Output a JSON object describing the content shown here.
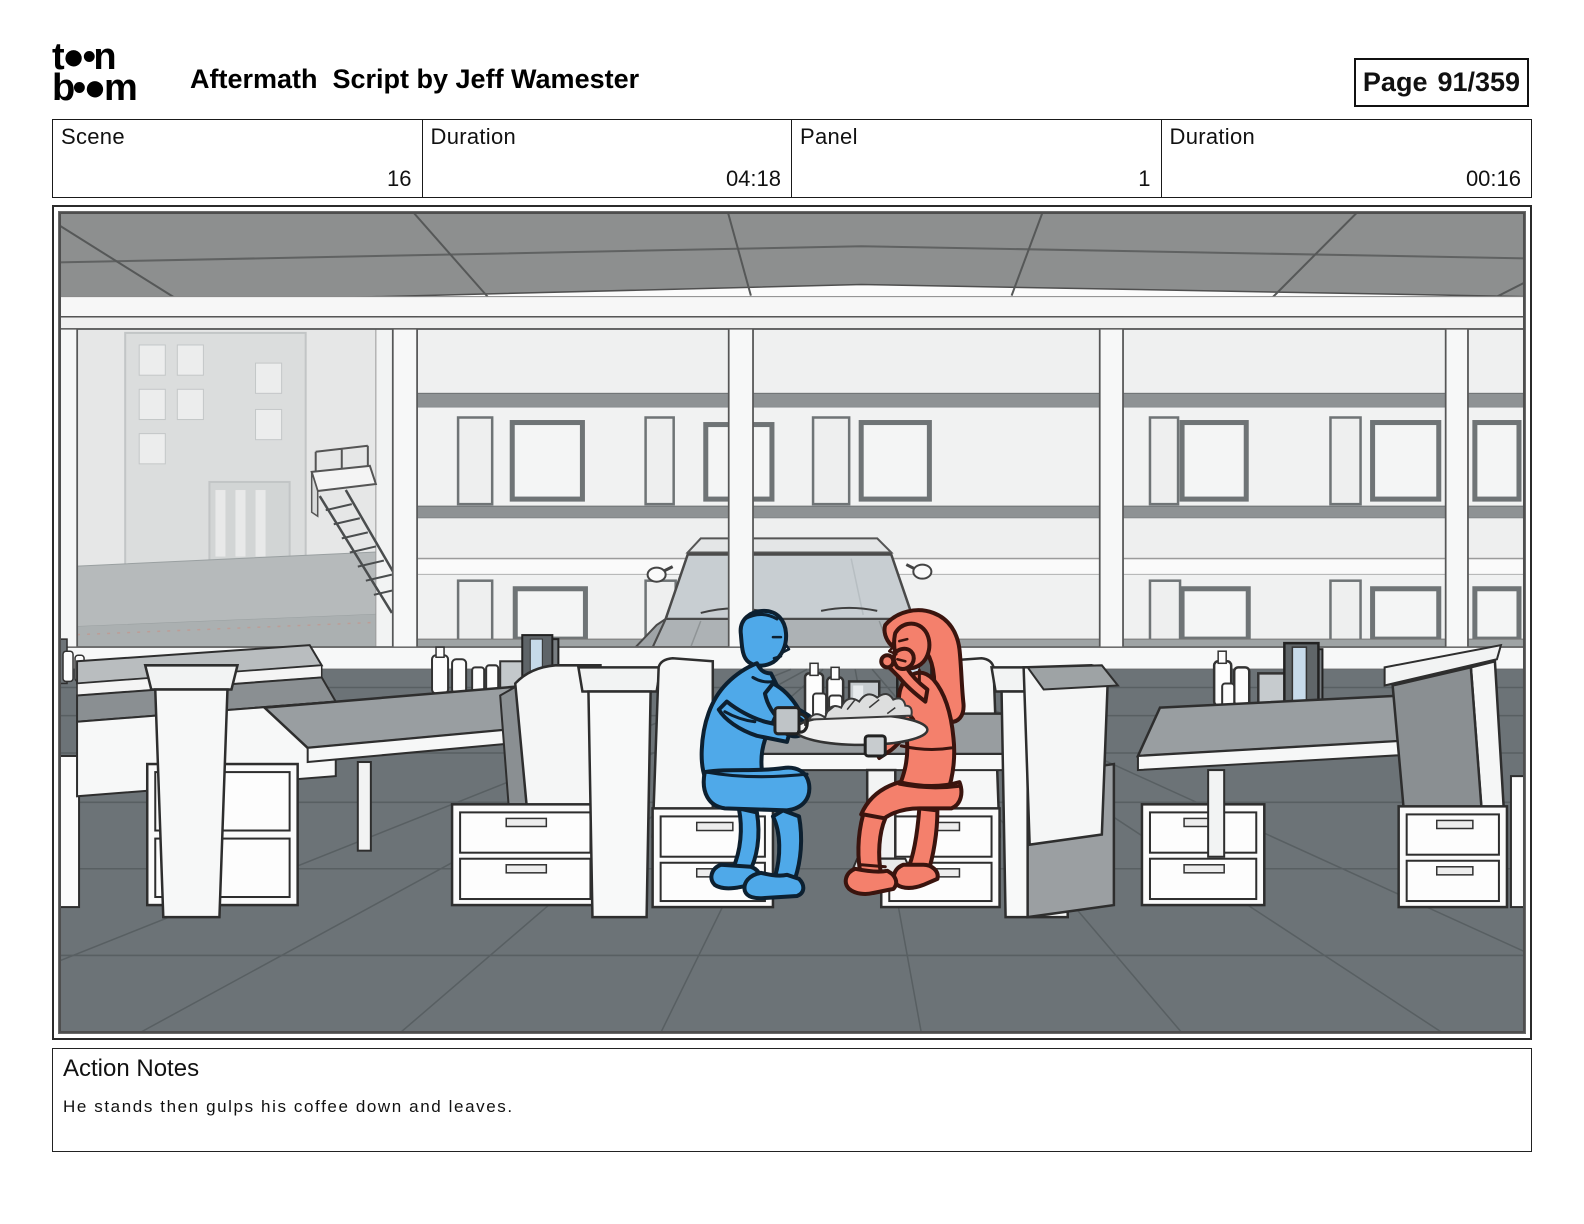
{
  "header": {
    "logo_line1": "t●•n",
    "logo_line2": "b•●m",
    "title": "Aftermath  Script by Jeff Wamester",
    "page_label": "Page",
    "page_value": "91/359"
  },
  "info_table": {
    "cells": [
      {
        "label": "Scene",
        "value": "16"
      },
      {
        "label": "Duration",
        "value": "04:18"
      },
      {
        "label": "Panel",
        "value": "1"
      },
      {
        "label": "Duration",
        "value": "00:16"
      }
    ]
  },
  "panel": {
    "description": "Storyboard drawing of a diner interior: rows of booths with drawers under the seats, a dark tiled floor, a gray ceiling grid, and large windows showing a two-story building, a fire-escape stair and a parked car. A blue-sketched man and a red-sketched woman sit facing each other at the center booth table set with condiment bottles, a napkin holder, menus, coffee mugs and a plate of fries.",
    "colors": {
      "character_blue": "#4FA9E9",
      "character_red": "#F4806C",
      "floor": "#6C7377",
      "ceiling": "#8D8F8F",
      "table": "#999EA1",
      "cushion": "#8A8F92"
    }
  },
  "action_notes": {
    "title": "Action Notes",
    "text": "He stands then gulps his coffee down and leaves."
  }
}
